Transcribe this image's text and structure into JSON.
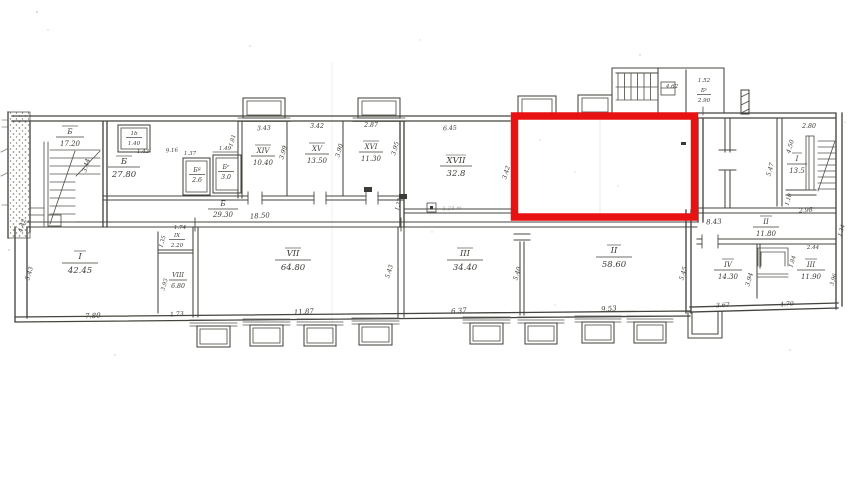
{
  "colors": {
    "highlight": "#e81212",
    "ink": "#45453f"
  },
  "rooms": {
    "stair_left": {
      "num": "Ƃ",
      "area": "17.20"
    },
    "closet_1b": {
      "num": "1b",
      "area": "1.40"
    },
    "g_27": {
      "num": "Ƃ",
      "area": "27.80"
    },
    "g_a": {
      "num": "Ƃª",
      "area": "2.6"
    },
    "g_e": {
      "num": "Ƃᵉ",
      "area": "3.0"
    },
    "xiv": {
      "num": "XIV",
      "area": "10.40"
    },
    "xv": {
      "num": "XV",
      "area": "13.50"
    },
    "xvi": {
      "num": "XVI",
      "area": "11.30"
    },
    "corridor_g": {
      "num": "Ƃ",
      "area": "29.30"
    },
    "xvii": {
      "num": "XVII",
      "area": "32.8"
    },
    "g_p": {
      "num": "Ƃᵖ",
      "area": "2.90"
    },
    "stair_right": {
      "num": "I",
      "area": "13.5"
    },
    "corridor_ii": {
      "num": "II",
      "area": "11.80"
    },
    "room_i": {
      "num": "I",
      "area": "42.45"
    },
    "ix": {
      "num": "IX",
      "area": "2.20"
    },
    "viii": {
      "num": "VIII",
      "area": "6.80"
    },
    "vii": {
      "num": "VII",
      "area": "64.80"
    },
    "iii_main": {
      "num": "III",
      "area": "34.40"
    },
    "ii_main": {
      "num": "II",
      "area": "58.60"
    },
    "iv": {
      "num": "IV",
      "area": "14.30"
    },
    "iii_right": {
      "num": "III",
      "area": "11.90"
    }
  },
  "dims": {
    "top_xiv": "3.43",
    "top_xv": "3.42",
    "top_xvi": "2.87",
    "top_xvii": "6.45",
    "top_stair_right": "2.80",
    "top_struct": "4.62",
    "top_room_w": "1.52",
    "corridor_len": "18.50",
    "v_left": "4.42",
    "v_g27": "3.44",
    "v_xiv": "3.99",
    "v_xv": "3.90",
    "v_xvi": "3.95",
    "v_closet": "1.81",
    "v_redbox": "3.42",
    "v_mid_right": "5.47",
    "v_stair_right": "4.50",
    "v_stair_low": "1.10",
    "w_stair_low": "2.98",
    "v_corr_right": "1.34",
    "closets_w": "9.16",
    "closet_gap": "1.37",
    "closet_ge_w": "1.49",
    "closet_1b_w": "1.43",
    "corr2_len": "8.43",
    "room_i_w": "7.80",
    "room_i_h": "5.43",
    "gap_i": "1.73",
    "ix_w": "1.74",
    "ix_h": "1.35",
    "viii_h": "3.93",
    "vii_w": "11.87",
    "vii_h": "5.43",
    "iii_w": "6.37",
    "iii_h": "5.40",
    "ii_w": "9.53",
    "ii_h": "5.45",
    "iv_w": "3.62",
    "iv_h": "3.94",
    "iii_r_w": "4.70",
    "iii_r_h": "3.96",
    "iii_r_d1": "2.44",
    "iii_r_d2": "1.84",
    "xvii_note": "5.24 m",
    "xvii_door": "1.37"
  }
}
